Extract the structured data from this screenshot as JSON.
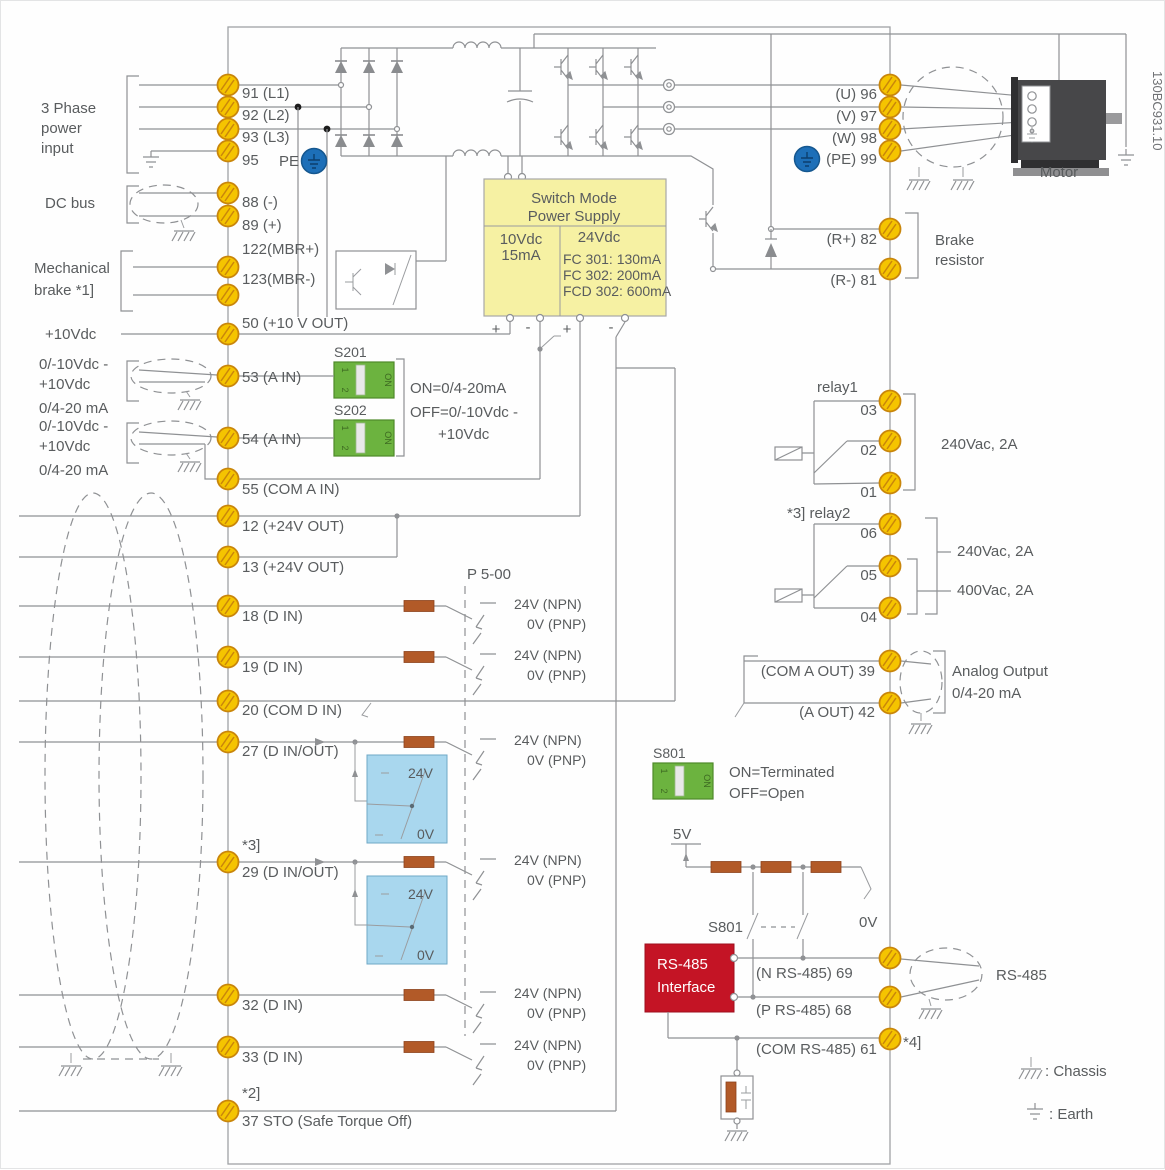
{
  "figure_code": "130BC931.10",
  "colors": {
    "terminal_yellow": "#F5C400",
    "smps_yellow": "#F6F1A3",
    "dip_green": "#6CB33F",
    "interface_red": "#C41425",
    "pe_blue": "#1D6FB8",
    "io_box_blue": "#A9D7EE",
    "resistor_brown": "#B25A28",
    "line_gray": "#8F9194",
    "text_gray": "#595C5E"
  },
  "left": {
    "three_phase": [
      "3 Phase",
      "power",
      "input"
    ],
    "dc_bus": "DC bus",
    "mech_brake": [
      "Mechanical",
      "brake *1]"
    ],
    "plus10": "+10Vdc",
    "analog_in": {
      "r1": "0/-10Vdc -",
      "r2": "+10Vdc",
      "ma": "0/4-20 mA"
    },
    "pe": "PE"
  },
  "tl": {
    "t91": "91 (L1)",
    "t92": "92 (L2)",
    "t93": "93 (L3)",
    "t95": "95",
    "t88": "88 (-)",
    "t89": "89 (+)",
    "t122": "122(MBR+)",
    "t123": "123(MBR-)",
    "t50": "50 (+10 V OUT)",
    "t53": "53 (A IN)",
    "t54": "54 (A IN)",
    "t55": "55 (COM A IN)",
    "t12": "12 (+24V OUT)",
    "t13": "13 (+24V OUT)",
    "t18": "18 (D IN)",
    "t19": "19 (D IN)",
    "t20": "20    (COM D IN)",
    "t27": "27    (D IN/OUT)",
    "n29": "*3]",
    "t29": "29    (D IN/OUT)",
    "t32": "32 (D IN)",
    "t33": "33 (D IN)",
    "n37": "*2]",
    "t37": "37 STO (Safe Torque Off)"
  },
  "tr": {
    "t96": "(U) 96",
    "t97": "(V) 97",
    "t98": "(W) 98",
    "t99": "(PE) 99",
    "t82": "(R+) 82",
    "t81": "(R-) 81",
    "r1": [
      "03",
      "02",
      "01"
    ],
    "r2": [
      "06",
      "05",
      "04"
    ],
    "t39": "(COM A OUT) 39",
    "t42": "(A OUT) 42",
    "t69": "(N RS-485) 69",
    "t68": "(P RS-485) 68",
    "t61": "(COM RS-485) 61",
    "n61": "*4]"
  },
  "smps": {
    "title": [
      "Switch Mode",
      "Power Supply"
    ],
    "col10": [
      "10Vdc",
      "15mA"
    ],
    "col24": "24Vdc",
    "ratings": [
      "FC 301: 130mA",
      "FC 302: 200mA",
      "FCD 302: 600mA"
    ],
    "plus": "+",
    "minus": "-"
  },
  "dip": {
    "s201": "S201",
    "s202": "S202",
    "s801": "S801",
    "on": "ON",
    "p1": "1",
    "p2": "2"
  },
  "notes": {
    "s20x": [
      "ON=0/4-20mA",
      "OFF=0/-10Vdc -",
      "+10Vdc"
    ],
    "s801": [
      "ON=Terminated",
      "OFF=Open"
    ],
    "param": "P 5-00",
    "npn": "24V (NPN)",
    "pnp": "0V (PNP)",
    "v24": "24V",
    "v0": "0V",
    "v5": "5V",
    "s801_sw": "S801",
    "v0_sw": "0V"
  },
  "right": {
    "motor": "Motor",
    "brake": [
      "Brake",
      "resistor"
    ],
    "relay1": "relay1",
    "relay2": "*3]  relay2",
    "r240": "240Vac, 2A",
    "r240b": "240Vac, 2A",
    "r400": "400Vac, 2A",
    "aout": [
      "Analog Output",
      "0/4-20 mA"
    ],
    "rs485_box": [
      "RS-485",
      "Interface"
    ],
    "rs485": "RS-485",
    "legend_chassis": ": Chassis",
    "legend_earth": ": Earth"
  }
}
